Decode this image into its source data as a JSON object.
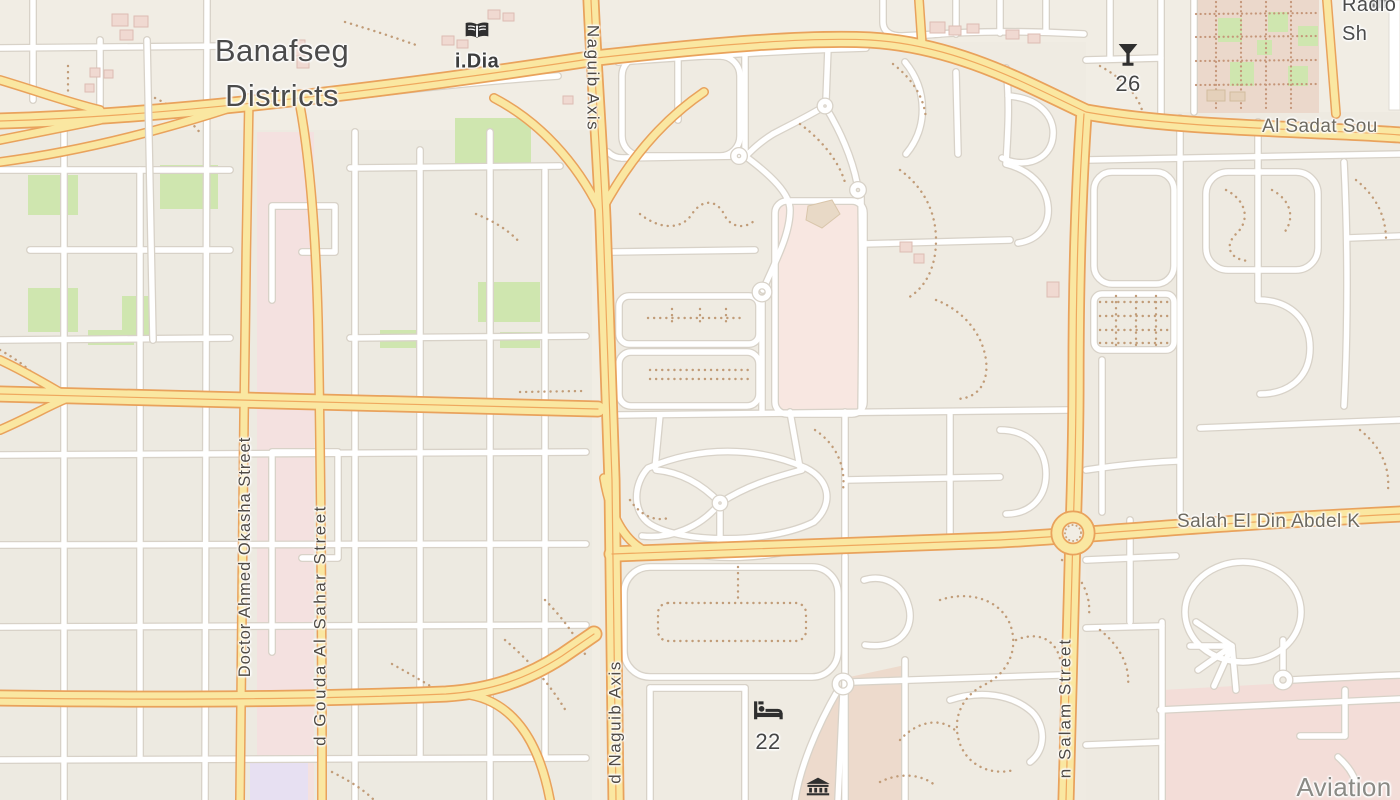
{
  "map": {
    "kind": "street-map",
    "place_labels": {
      "banafseg": {
        "text": "Banafseg\nDistricts"
      },
      "radio_shack": {
        "text": "Radio Sh"
      },
      "aviation": {
        "text": "Aviation"
      }
    },
    "road_labels": {
      "al_sadat": {
        "text": "Al Sadat Sou"
      },
      "salah_el_din": {
        "text": "Salah El Din Abdel K"
      },
      "okasha": {
        "text": "Doctor Ahmed Okasha Street"
      },
      "gouda_sahar": {
        "text": "d Gouda Al Sahar Street"
      },
      "naguib_top": {
        "text": "Naguib Axis"
      },
      "naguib_bottom": {
        "text": "d Naguib Axis"
      },
      "salam": {
        "text": "n Salam Street"
      }
    },
    "pois": {
      "library": {
        "icon": "open-book-icon",
        "label": "i.Dia"
      },
      "bar": {
        "icon": "cocktail-icon",
        "label": "26"
      },
      "hotel": {
        "icon": "bed-icon",
        "label": "22"
      },
      "museum": {
        "icon": "museum-icon",
        "label": ""
      }
    },
    "colors": {
      "land": "#f1ede4",
      "residential_block": "#edeae1",
      "road_major_fill": "#fae7a1",
      "road_major_casing": "#e9a25c",
      "road_minor_fill": "#ffffff",
      "road_minor_casing": "#d8d2c8",
      "park_green": "#cfe6af",
      "retail_pink": "#f4e1e0",
      "market_pink": "#ebd8cb",
      "museum_tan": "#eddacc",
      "path_dots": "#c19c78",
      "purple_area": "#e7e0f2",
      "label_place": "#4b4b4b",
      "label_road": "#6e6a60",
      "label_street": "#4f4a44",
      "label_landuse": "#8a8a85",
      "icon_dark": "#2f2f2f"
    }
  }
}
